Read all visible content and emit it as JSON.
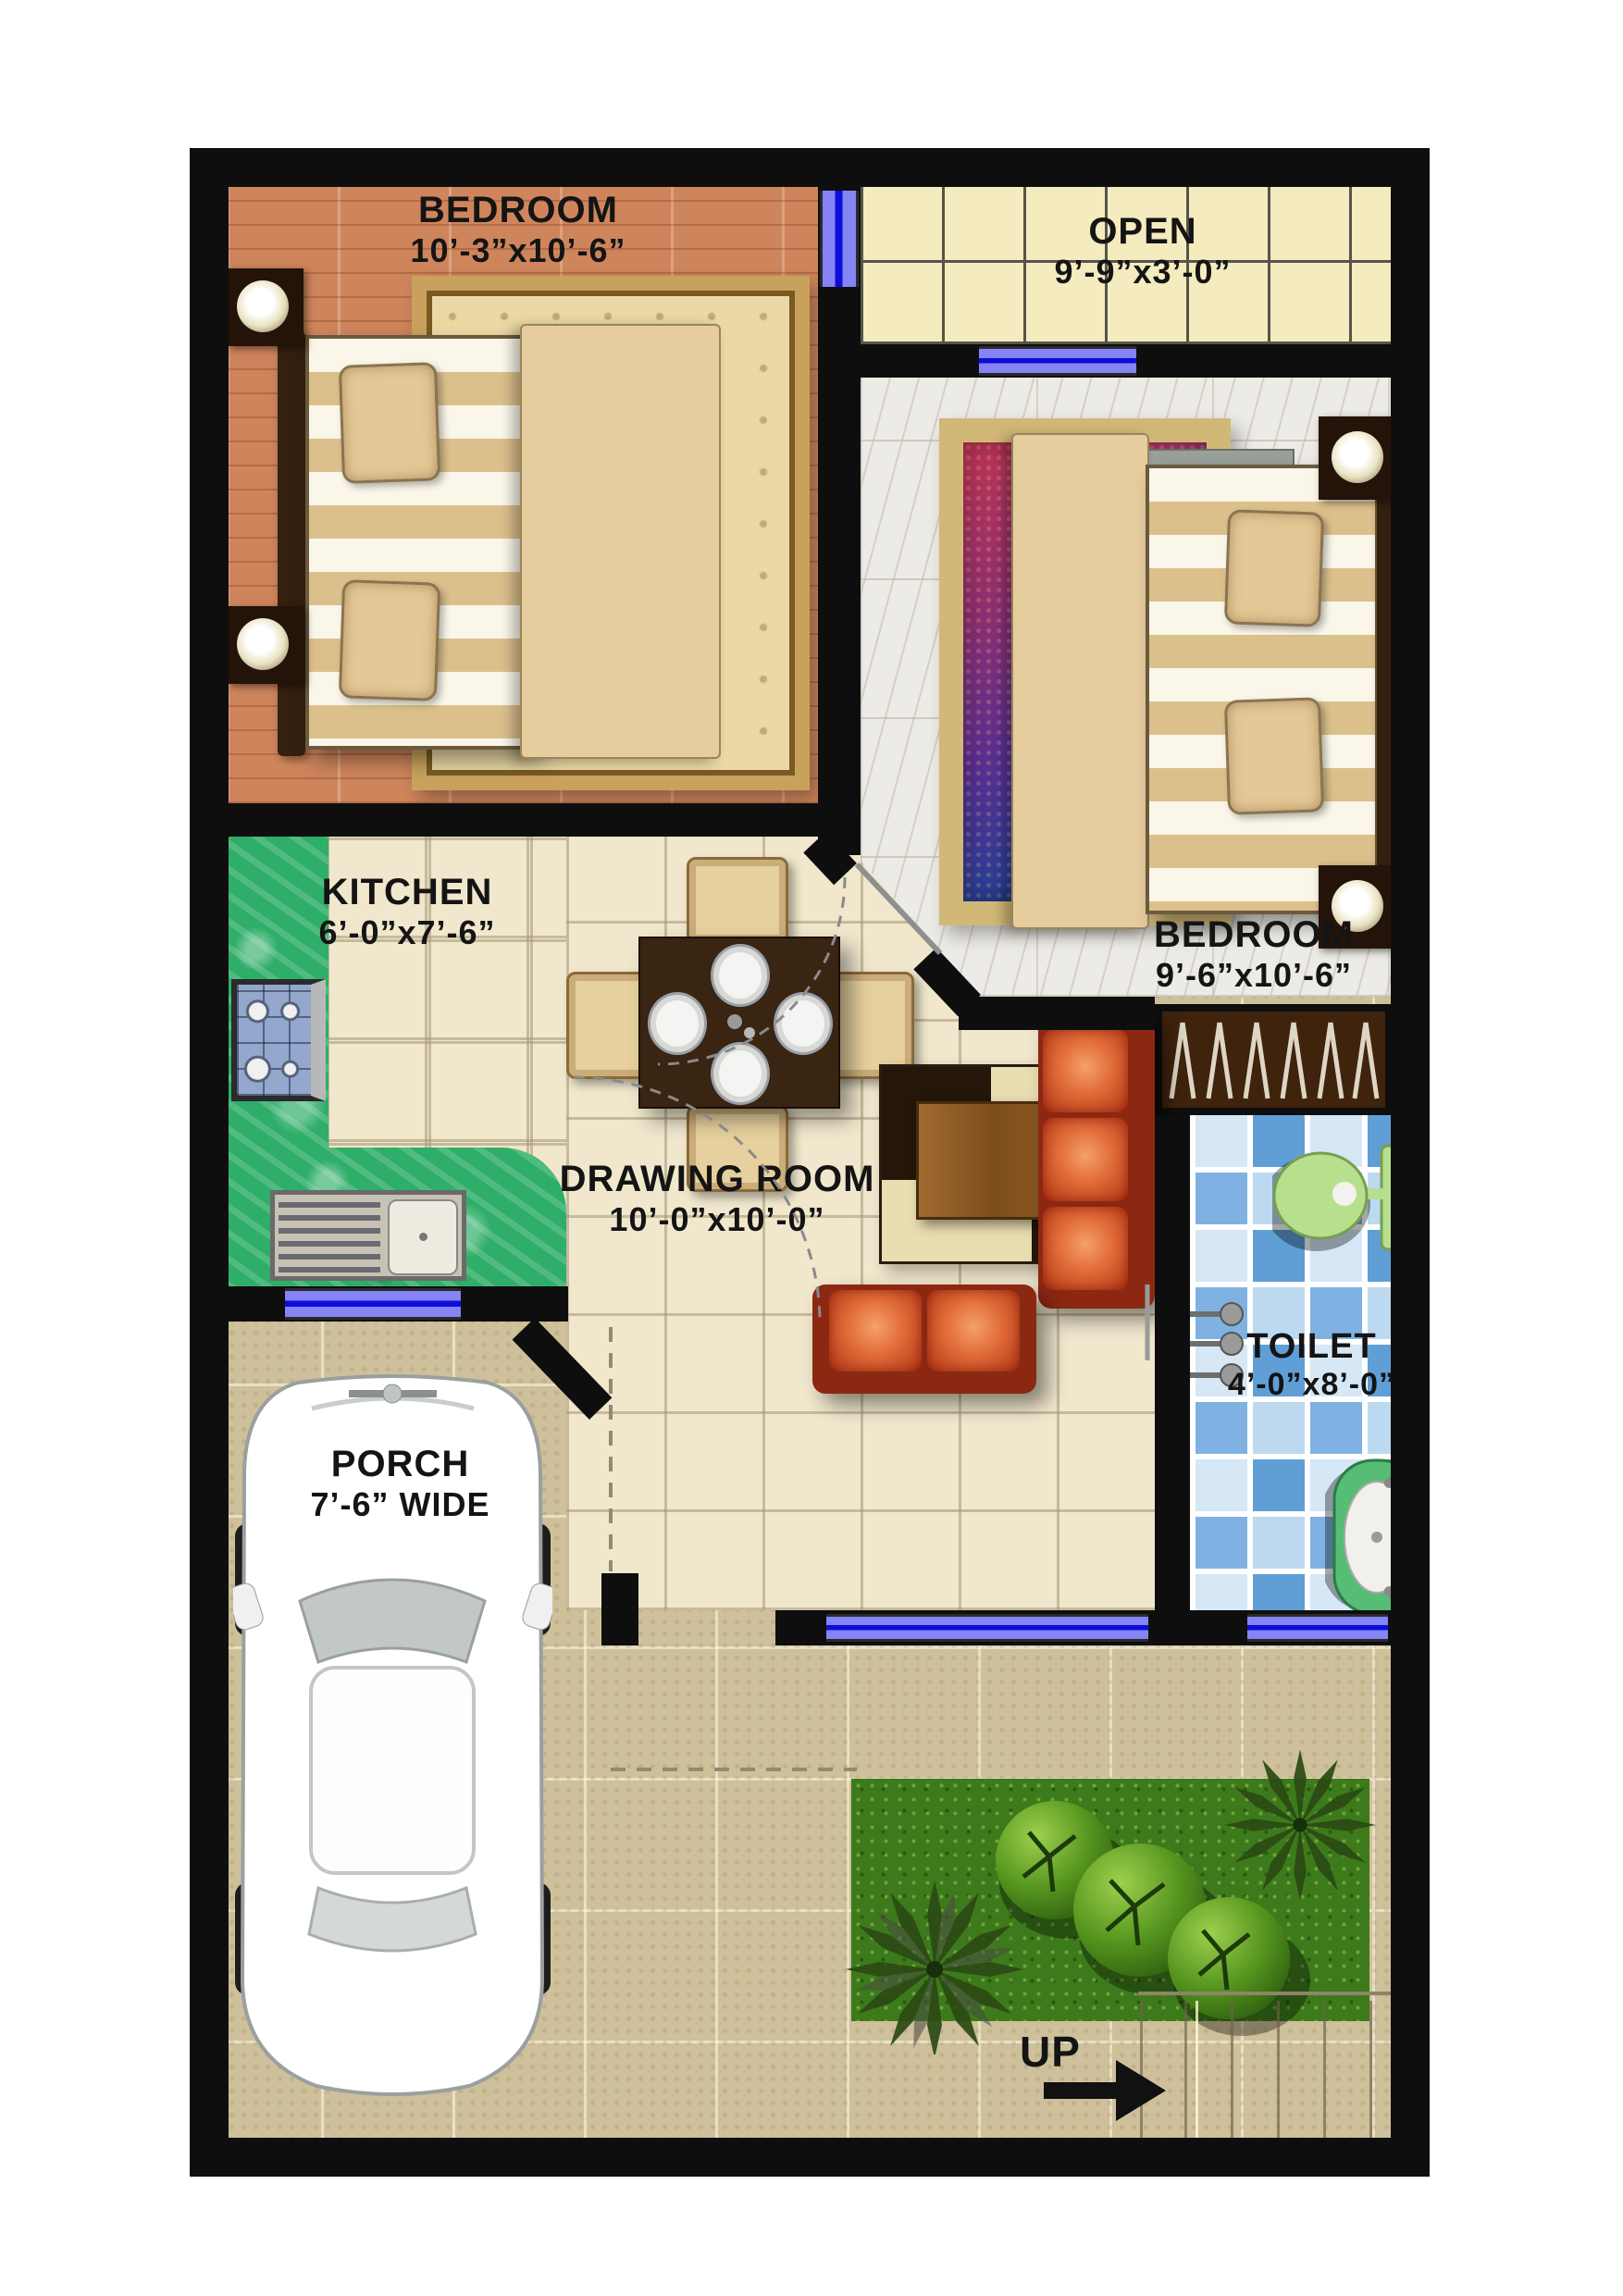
{
  "rooms": {
    "bedroom1": {
      "label": "BEDROOM",
      "size": "10’-3”x10’-6”"
    },
    "open_area": {
      "label": "OPEN",
      "size": "9’-9”x3’-0”"
    },
    "bedroom2": {
      "label": "BEDROOM",
      "size": "9’-6”x10’-6”"
    },
    "kitchen": {
      "label": "KITCHEN",
      "size": "6’-0”x7’-6”"
    },
    "drawing_room": {
      "label": "DRAWING ROOM",
      "size": "10’-0”x10’-0”"
    },
    "toilet": {
      "label": "TOILET",
      "size": "4’-0”x8’-0”"
    },
    "porch": {
      "label": "PORCH",
      "size": "7’-6” WIDE"
    }
  },
  "stairs": {
    "label": "UP"
  },
  "colors": {
    "wall": "#0e0e0e",
    "window": "#8484f4",
    "window_line": "#0d0dd8",
    "wood_floor": "#cf855c",
    "open_tile": "#f4ebbe",
    "marble": "#edebe5",
    "kitchen_counter": "#2fae69",
    "toilet_tile": "#7fb2e2",
    "sofa": "#d4502a",
    "outdoor_tile": "#cec09a",
    "grass": "#3d7a1b"
  }
}
